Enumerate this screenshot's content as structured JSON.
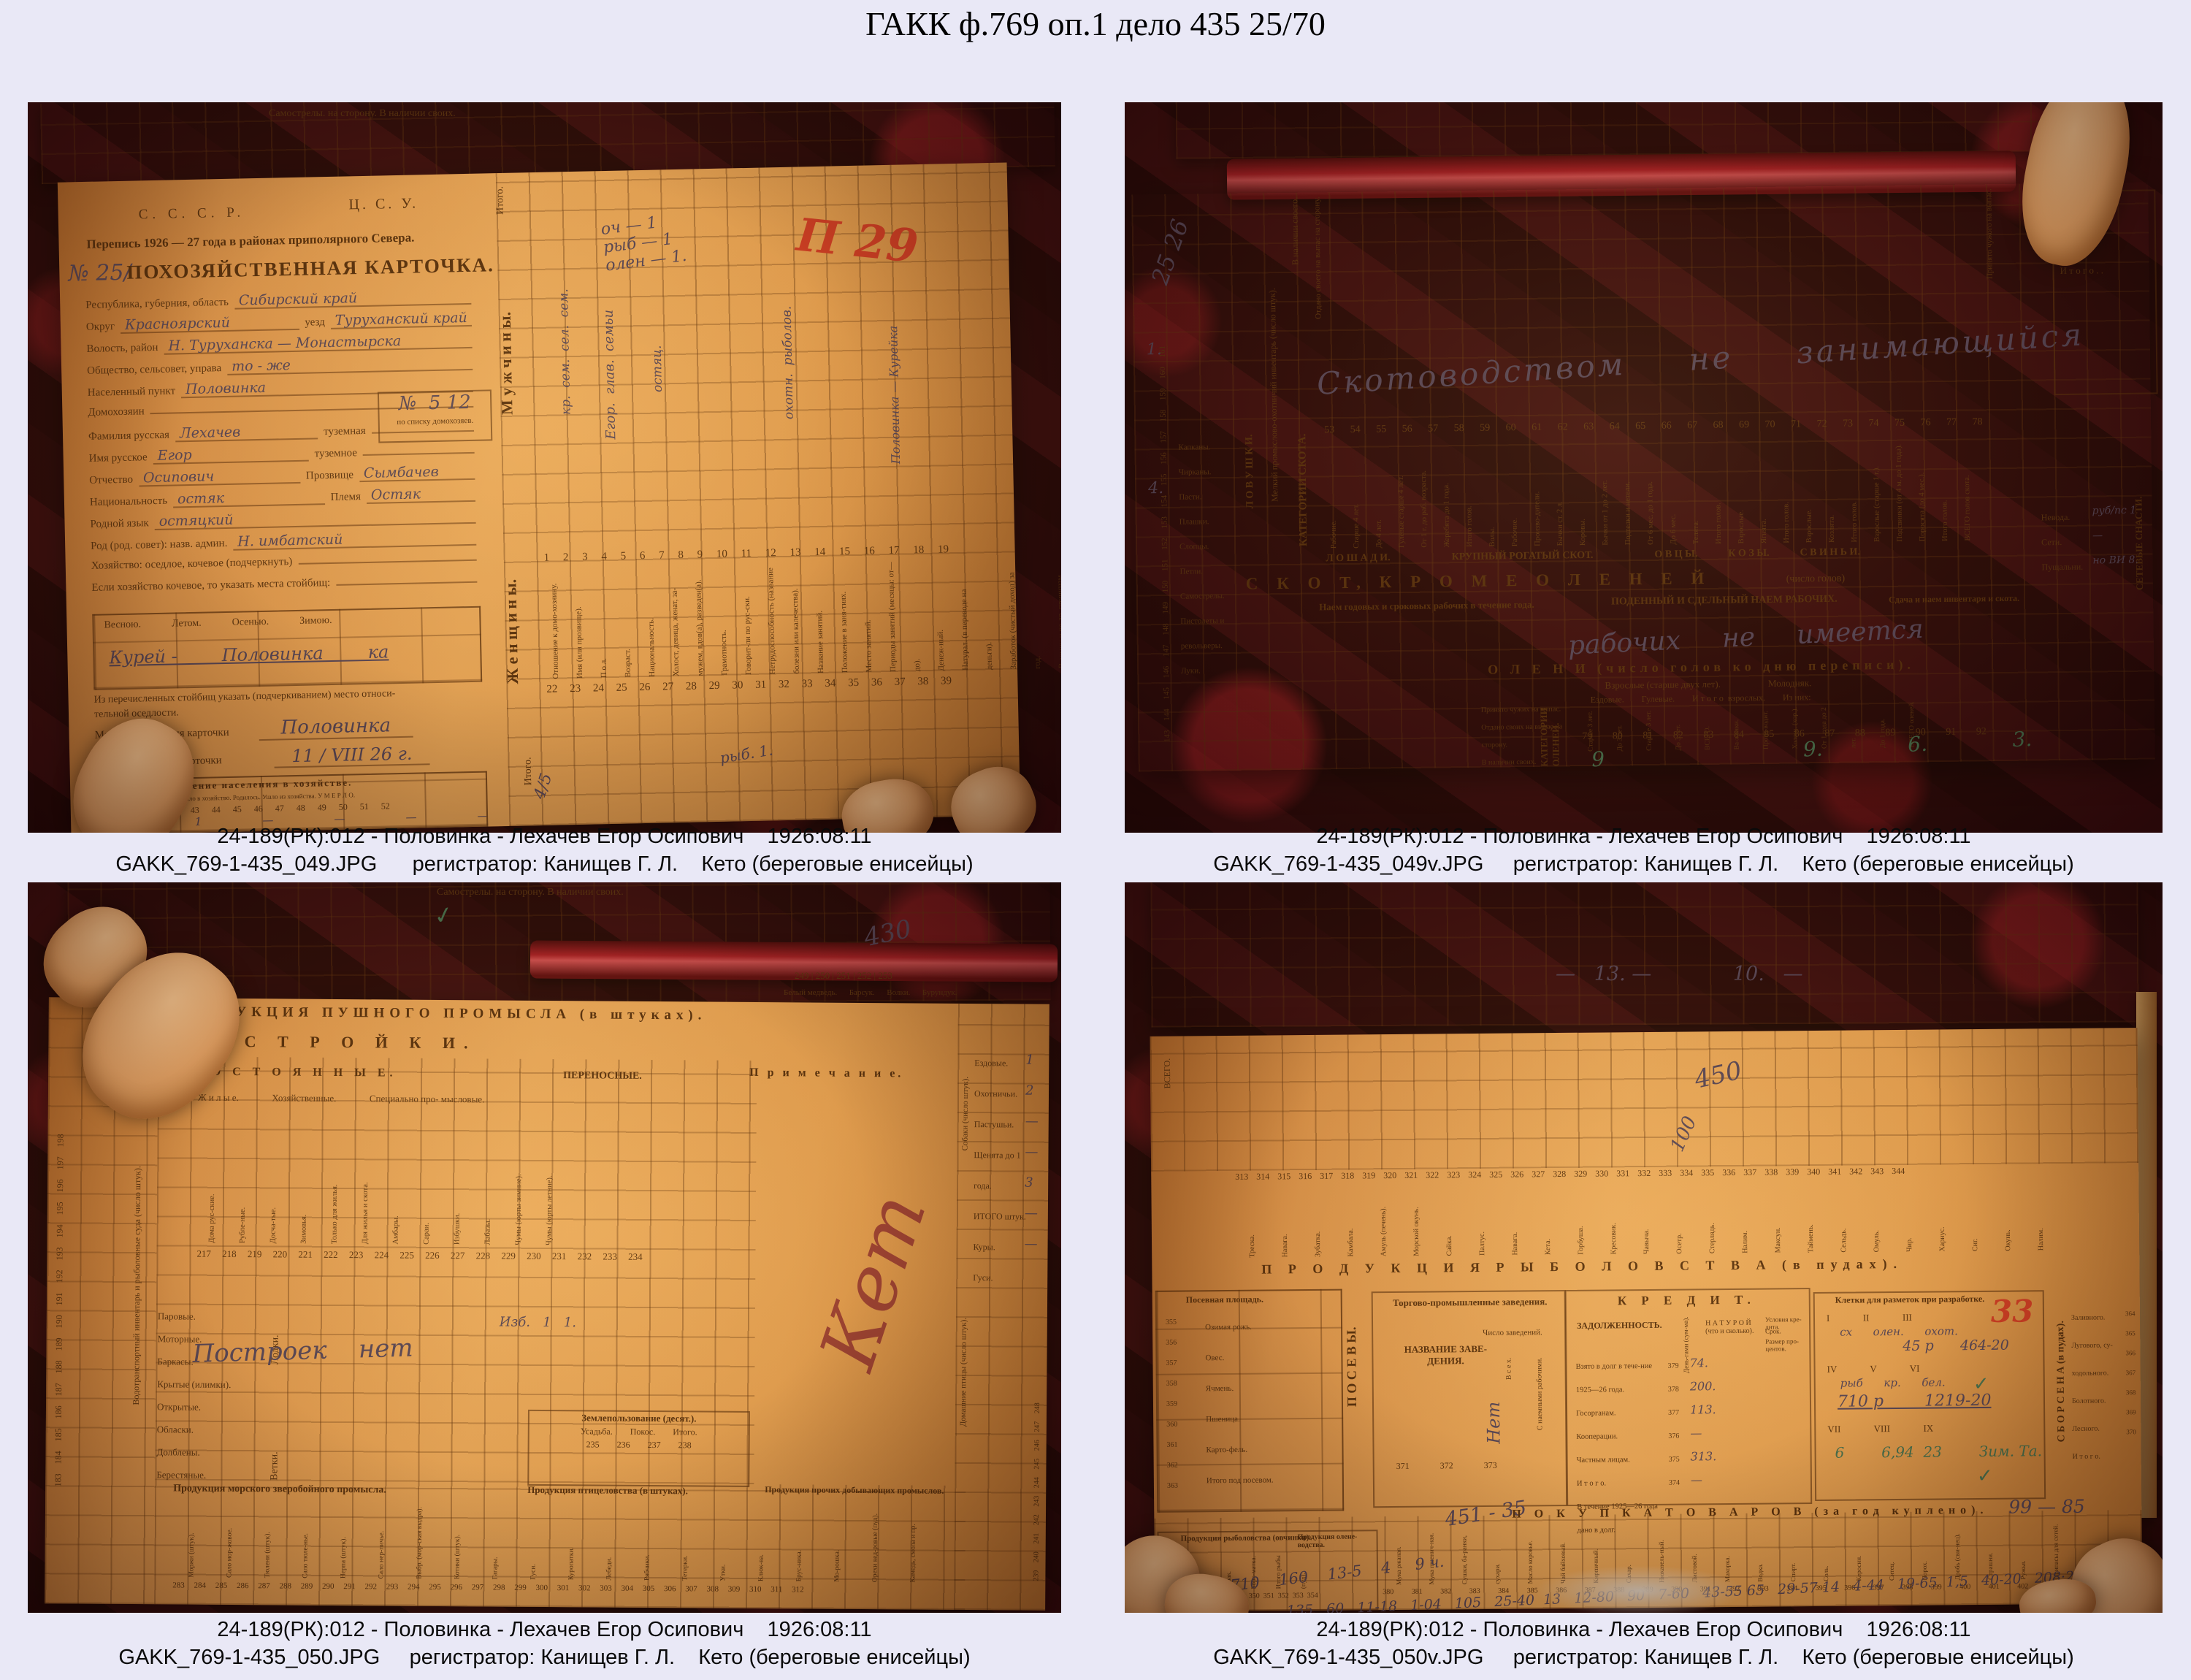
{
  "page": {
    "title": "ГАКК ф.769 оп.1 дело 435 25/70",
    "background": "#e9e8f6"
  },
  "colors": {
    "accent_red_mark": "#cb3a24",
    "page_orange": "#dd9c4e",
    "cloth": "#2a0709",
    "ink": "#50300f",
    "handwriting_ink": "#4b4258",
    "green_ink": "#3c7050"
  },
  "photos": [
    {
      "file": "GAKK_769-1-435_049.JPG",
      "caption1": "24-189(РК):012 - Половинка - Лехачев Егор Осипович    1926:08:11",
      "caption2": "GAKK_769-1-435_049.JPG      регистратор: Канищев Г. Л.    Кето (береговые енисейцы)",
      "doc": {
        "strip_labels": "Самострелы.                на сторону.                В наличии своих.",
        "sssr": "С. С. С. Р.",
        "csu": "Ц. С. У.",
        "census": "Перепись 1926 — 27 года в районах приполярного Севера.",
        "num_hw": "№ 25/",
        "card_title": "ПОХОЗЯЙСТВЕННАЯ КАРТОЧКА.",
        "fields": [
          {
            "label": "Республика, губерния, область",
            "value": "Сибирский край"
          },
          {
            "label": "Округ",
            "value": "Красноярский",
            "label2": "уезд",
            "value2": "Туруханский край"
          },
          {
            "label": "Волость, район",
            "value": "Н. Туруханска — Монастырска"
          },
          {
            "label": "Общество, сельсовет, управа",
            "value": "то - же"
          },
          {
            "label": "Населенный пункт",
            "value": "Половинка"
          },
          {
            "label": "Домохозяин",
            "value": ""
          },
          {
            "label": "Фамилия русская",
            "value": "Лехачев",
            "label2": "туземная",
            "value2": ""
          },
          {
            "label": "Имя русское",
            "value": "Егор",
            "label2": "туземное",
            "value2": ""
          },
          {
            "label": "Отчество",
            "value": "Осипович",
            "label2": "Прозвище",
            "value2": "Сымбачев"
          },
          {
            "label": "Национальность",
            "value": "остяк",
            "label2": "Племя",
            "value2": "Остяк"
          },
          {
            "label": "Родной язык",
            "value": "остяцкий"
          },
          {
            "label": "Род (род. совет): назв. админ.",
            "value": "Н. имбатский"
          },
          {
            "label": "Хозяйство: оседлое, кочевое (подчеркнуть)",
            "value": ""
          },
          {
            "label": "Если хозяйство кочевое, то указать места стойбищ:",
            "value": ""
          }
        ],
        "household_box_no": "№  5 12",
        "household_box_label": "по списку домохозяев.",
        "seasons_heads": "Весною.            Летом.            Осенью.            Зимою.",
        "seasons_hw": "Курей -        Половинка        ка",
        "settle_note": "Из перечисленных стойбищ указать (подчеркиванием) место относи-\nтельной оседлости.",
        "place_label": "Место составления карточки",
        "place_hw": "Половинка",
        "date_label": "Дата составления карточки",
        "date_hw": "11 / VIII 26 г.",
        "movement_title": "Движение населения в хозяйстве.",
        "movement_heads": "Всего было к началу года.   Вошло в хозяйство.   Родилось.   Ушло из хозяйства.   У М Е Р Л О.",
        "movement_nums": "40   41   42   43   44   45   46   47   48   49   50   51   52",
        "movement_row1": "4    1    —    —    —    —    —    —    —    —    —    —",
        "movement_row2": "4    1",
        "rot_itogo_top": "Итого.",
        "rot_men": "М у ж ч и н ы.",
        "rot_women": "Ж е н щ и н ы.",
        "rot_itogo_bottom": "Итого.",
        "hw_marks": "оч — 1\nрыб — 1\nолен — 1.",
        "red_mark": "П 29",
        "table_nums_top": "1    2    3    4   5   6    7   8   9    10    11    12    13    14    15   16   17   18   19",
        "col_heads": "Отношение к домо-хозяину.\nИмя (или прозвище).\nП о л.\nВозраст.\nНациональность.\nХолост, девица, женат, за-мужем, вдов(а), разведен(а).\nГрамотность.\nГоворит-ли по рус-ски.\nНетрудоспособность (название болезни или калечества).\nНазвание занятий.\nПоложение в заня-тиях.\nМесто занятий.\nПериоды занятий (месяцы: от—до).\nДенеж-ный.\nНатурал. (в переводе на деньги).\nЗаработок (чистый доход) за год.\nВ армии и по др. причинам.\nНазвание организаций, где состоит членом (кооперация, профсоюз и др.).",
        "table_nums_mid": "22    23    24   25   26    27   28   29    30    31    32    33    34    35   36   37   38   39",
        "hw_v1": "кр.  сем.  сел.  сем.",
        "hw_v2": "Егор.  глав.  семьи",
        "hw_v3": "остяц.",
        "hw_v4": "охотн.  рыболов.",
        "hw_v5": "Половинка — Курейка",
        "hw_fish": "рыб. 1.",
        "hw_itogo": "4/5"
      }
    },
    {
      "file": "GAKK_769-1-435_049v.JPG",
      "caption1": "24-189(РК):012 - Половинка - Лехачев Егор Осипович    1926:08:11",
      "caption2": "GAKK_769-1-435_049v.JPG     регистратор: Канищев Г. Л.    Кето (береговые енисейцы)",
      "doc": {
        "hw_25": "25 26",
        "avail_label": "В наличии своего.",
        "given_label": "Отдано своего на выпас на сторону.",
        "taken_label": "Принято чужого на выпас.",
        "hw_main": "Скотоводством     не     занимающийся",
        "nums": "53  54  55  56  57  58  59  60  61  62  63  64  65  66  67  68  69  70  71  72  73  74  75  76  77  78",
        "col_heads": "Рабочие.\nСтарше 4 лет.\nДо 4 лет.\nГулевые старше 4 лет.\nОт 1 г. до раб. возраста.\nЖеребята до 1 года.\nИтого голов.\nВолы.\nРабочие.\nПроизво-дители.\nБычки ст. 2 л.\nКоровы.\nБычки от 1 до 2 лет.\nПодтелки и нетели.\nОт 6 мес. до 1 года.\nДо 6 мес.\nТелята.\nИтого голов.\nВзрослые.\nЯгнята.\nИтого голов.\nВзрослые.\nКозлята.\nИтого голов.\nВзрослые (старше 1 г.).\nПодсвинки (от 4 м. до 1 года).\nПоросята (до 4 мес.).\nИтого голов.\nВСЕГО голов скота.",
        "band_groups": "Л О Ш А Д И.                        КРУПНЫЙ РОГАТЫЙ СКОТ.                        О В Ц Ы.            К О З Ы.            С В И Н Ь И.",
        "band_skot": "С К О Т,     К Р О М Е     О Л Е Н Е Й",
        "band_skot_sub": "(число голов)",
        "cat_skota": "КАТЕГОРИИ СКОТА.",
        "naem_title": "Наем годовых и сроковых рабочих в течение года.",
        "poden_title": "ПОДЕННЫЙ И СДЕЛЬНЫЙ НАЕМ РАБОЧИХ.",
        "sdacha_title": "Сдача и наем инвентаря и скота.",
        "hw_workers": "рабочих     не     имеется",
        "olen_band": "О Л Е Н И      (число голов ко дню переписи).",
        "cat_olenei": "КАТЕГОРИИ ОЛЕНЕЙ.",
        "olen_heads": "Взрослые (старше двух лет).                    Молодняк.",
        "olen_sub": "Ездовые.        Гулевые.        И т о г о  взрослых.        Из них:",
        "olen_cols": "Старше 3 лет.\nДо 3 лет.\nСтарше 3 лет.\nДо 3 лет.\nВСЕГО.\nВа-женки.\nПроиз-водит.\nХолощ. (хор.).\nОт 1 года до 2 лет.\nДо 1 года.\nВСЕГО оленей.",
        "olen_nums": "79   80   81   82   83   84   85   86   87   88   89   90   91   92",
        "olen_rows": "Принято чужих на выпас.\nОтдано своих на выпас на сторону.\nВ наличии своих.",
        "hw_olen_vals": "9       9.   6.   3.         и   13.   9   6",
        "lovushki_band": "Л О В У Ш К И.",
        "lovushki_cols": "Капканы.\nЧирканы.\nПасти.\nПлашки.\nСлопцы.\nПетли.\nСамострелы.\nПистолеты и револьверы.\nЛуки.",
        "lovushki_nums": "143 144 145 146 147 148 149 150 151 152 153 154 155 156 157 158 159 160 161",
        "hw_luki": "1.",
        "hw_kapkany": "4.",
        "inv_band": "Мелкий промыслово-охотничий инвентарь (число штук).",
        "right_box": "Рыболовство.\nОхота . . .\nИ т о г о . .",
        "right_band": "СЕТЕВЫЕ СНАСТИ.",
        "right_rows": "Невода.\nСети.\nПущальни.",
        "hw_right": "руб/пс 1\n—\nно ВИ  8."
      }
    },
    {
      "file": "GAKK_769-1-435_050.JPG",
      "caption1": "24-189(РК):012 - Половинка - Лехачев Егор Осипович    1926:08:11",
      "caption2": "GAKK_769-1-435_050.JPG     регистратор: Канищев Г. Л.    Кето (береговые енисейцы)",
      "doc": {
        "strip_labels": "Самострелы.                на сторону.                В наличии своих.",
        "check": "✓",
        "hw_430": "430",
        "left_nums": "183 184 185 186 187 188 189 190 191 192 193 194 195 196 197 198",
        "left_title": "Водотранспортный инвентарь и рыболовные суда (число штук).",
        "left_cols": "Паровые.\nМоторные.\nБаркасы.\nКрытые (илимки).\nОткрытые.\nОбласки.\nДолблены.\nБерестяные.",
        "left_grp1": "Лодки.",
        "left_grp2": "Ветки.",
        "band_fur": "ПРОДУКЦИЯ   ПУШНОГО   ПРОМЫСЛА   (в штуках).",
        "band_build": "П О С Т Р О Й К И.",
        "sub_perm": "П О С Т О Я Н Н Ы Е.",
        "sub_port": "ПЕРЕНОСНЫЕ.",
        "sub_note": "П р и м е ч а н и е.",
        "grp_heads": "Ж и л ы е.              Хозяйственные.              Специально про- мысловые.",
        "cols_perm": "Дома рус-ские.\nРубле-ные.\nДосча-тые.\nЗимовья.\nТолько для жилья.\nДля жилья и скота.\nАмбары.\nСараи.\nИзбушки.\nЛабазы.\nЧумы (юрты зимние).\nЧумы (юрты летние).",
        "nums_build": "217  218  219  220  221  222  223  224  225  226  227  228  229  230      231      232      233      234",
        "hw_port": "Изб.   1   1.",
        "hw_build": "Построек    нет",
        "land_title": "Землепользование (десят.).",
        "land_cols": "Усадьба.        Покос.        Итого.",
        "land_nums": "235        236        237        238",
        "hw_ket": "Кет",
        "right_band1": "Собаки (число штук).",
        "right_band2": "Домашние птицы (число штук).",
        "right_rows": "Ездовые.\nОхотничьи.\nПастушьи.\nЩенята до 1 года.\nИТОГО штук.\nКуры.\nГуси.",
        "right_nums": "239 240 241 242 243 244 245 246 247 248",
        "right_vals": "1\n2\n—\n—\n3\n—\n—",
        "top_nums": "249 | 250 | 251 | 252 | 253",
        "top_cols": "Белый медведь.      Барсук.      Волки.      Бурундук.",
        "bottom_band1": "Продукция морского зверобойного промысла.",
        "bottom_band2": "Продукция птицеловства (в штуках).",
        "bottom_band3": "Продукция прочих добывающих промыслов.",
        "bottom_cols": "Моржи (штук).\nСало мор-жовое.\nТюлени (штук).\nСало тюле-нье.\nНерпа (штук).\nСало нер-пичье.\nВыбр. (мор-ская выдра).\nКотики (штук).\nГагары.\nГуси.\nКуропатки.\nЛебеди.\nРябчики.\nТетерки.\nУтки.\nКлюк-ва.\nБрус-ника.\nМо-рошка.\nОрехи кед-ровые (пуд).\nКамедь, смола и пр.",
        "bottom_nums": "283  284  285  286  287  288  289  290  291  292  293  294  295  296  297  298  299  300  301  302  303  304  305  306  307  308  309  310  311  312"
      }
    },
    {
      "file": "GAKK_769-1-435_050v.JPG",
      "caption1": "24-189(РК):012 - Половинка - Лехачев Егор Осипович    1926:08:11",
      "caption2": "GAKK_769-1-435_050v.JPG     регистратор: Канищев Г. Л.    Кето (береговые енисейцы)",
      "doc": {
        "hw_top": "—   13. —             10.   —",
        "hw_450": "450",
        "hw_100": "100",
        "vsego": "ВСЕГО.",
        "fish_nums": "313 314 315 316 317 318 319 320 321 322 323 324  325  326  327  328  329  330  331  332  333  334  335 336 337 338 339 340 341 342 343 344",
        "fish_cols": "Треска.\nНавага.\nЗубатка.\nКамбала.\nАмуль (печень).\nМорской окунь.\nСайка.\nПалтус.\nНавага.\nКета.\nГорбуша.\nКресовик.\nЧавыча.\nОсетр.\nСтерлядь.\nНалим.\nМаксун.\nТаймень.\nСельдь.\nОмуль.\nЧир.\nХариус.\nСиг.\nОкунь.\nНалим.",
        "band_fish": "П Р О Д У К Ц И Я      Р Ы Б О Л О В С Т В А      (в пудах).",
        "sow_title": "Посевная площадь.",
        "sow_cols": "Озимая рожь.\nОвес.\nЯчмень.\nПшеница.\nКарто-фель.\nИтого под посевом.",
        "sow_nums": "355\n356\n357\n358\n359\n360\n361\n362\n363",
        "posev_band": "П О С Е В Ы.",
        "trade_title": "Торгово-промышленные заведения.",
        "trade_name": "НАЗВАНИЕ ЗАВЕ-\nДЕНИЯ.",
        "trade_count": "Число заведений.",
        "trade_all": "В с е х.",
        "trade_hired": "С наемными рабочими.",
        "trade_nums": "371              372              373",
        "trade_hw": "Нет",
        "credit_title": "К  Р  Е  Д  И  Т.",
        "credit_debt": "ЗАДОЛЖЕННОСТЬ.",
        "credit_money": "День-гами (сум-ма).",
        "credit_nat": "Н А Т У Р О Й  (что и сколько).",
        "credit_cond": "Условия кре-дита.",
        "credit_term": "Срок.",
        "credit_pct": "Размер про-центов.",
        "credit_rows": "Взято в долг в тече-ние 1925—26 года.\nГосорганам.\nКооперации.\nЧастным лицам.\nИ т о г о.\nВ течение 1925—26 года дано в долг.",
        "credit_nums": "379\n378\n377\n376\n375\n374",
        "credit_vals": "74.\n200.\n113.\n—\n313.\n—",
        "cells_title": "Клетки для разметок при разработке.",
        "cells_r1": "I              II              III",
        "cells_r2": "IV              V              VI",
        "cells_r3": "VII              VIII              IX",
        "cells_hw1": "сх      олен.      охот.",
        "cells_hw2": "45 р      464-20",
        "cells_hw3": "рыб      кр.      бел.",
        "cells_hw4": "710 р        1219-20",
        "cells_hw5": "6        6,94  23        Зим. Та.",
        "red_33": "33",
        "hay_band": "С Б О Р   С Е Н А   (в пудах).",
        "hay_cols": "Заливного.\nЛугового, су-ходольного.\nБолотного.\nЛесного.\nИ т о г о.",
        "hay_nums": "364\n365\n366\n367\n368\n369\n370",
        "hay_years": "В 1925 году.   В 1926 году.",
        "hw_451": "451 - 35",
        "buy_band": "П О К У П К А      Т О В А Р О В      (за год куплено).",
        "hw_99": "99 — 85",
        "fishprod_title": "Продукция рыболовства (овчинки).",
        "fishprod_cols": "Щука.\nЯзь.\nЧебак.\nБоро-матка.\nИтого рыбы (пуд).",
        "fishprod_nums": "345  346  347  348  349       350  351  352  353  354",
        "oleneprod_title": "Продукция олене- водства.",
        "buy_cols": "Мука ржаная.\nМука пшенич-ная.\nСушки, ба-ранки, сухари.\nМасло коровье.\nЧай байховый.\nКирпичный.\nСахар.\nНюхатель-ный.\nЛистовой.\nМахорка.\nВодка.\nСпирт.\nСоль.\nКеросин.\nСитец.\nПорох.\nДробь (сви-нец).\nСтрашни.\nРужья.\nПрипасы для сетей.",
        "buy_nums": "380  381  382  383      384      385  386  387      388  389  390  391  392  393  394  395  396  397  398  399  400  401  402  403  404",
        "hw_bottom1": "25-10    710    160    13-5    4     9 ч.",
        "hw_bottom2": "135   60   11-18   1-04   105   25-40  13   12-80   90   7-60   43-55 65   29-57 14   4-44   19-65  1,5   40-20   208·208"
      }
    }
  ]
}
